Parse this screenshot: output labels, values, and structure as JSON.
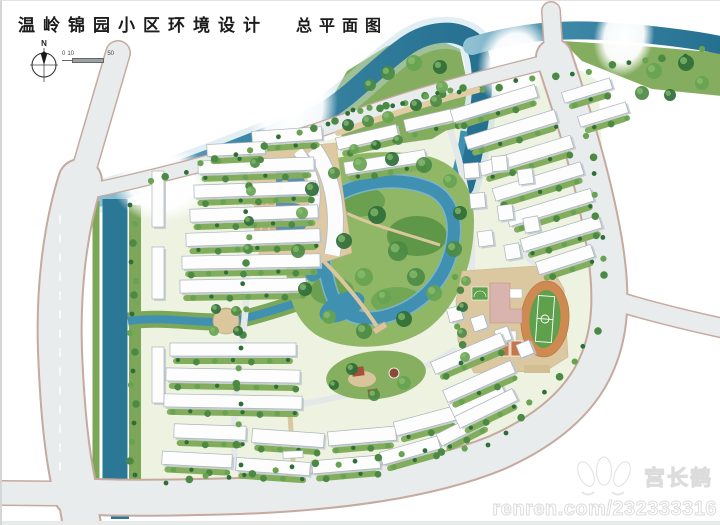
{
  "header": {
    "title": "温岭锦园小区环境设计",
    "subtitle": "总平面图"
  },
  "compass": {
    "north_label": "N"
  },
  "scale_bar": {
    "zero": "0",
    "ten": "10",
    "fifty": "50"
  },
  "watermark": {
    "name": "宫长鹤",
    "url": "renren.com/232333316"
  },
  "palette": {
    "road": "#e8eced",
    "road_edge": "#c6a99f",
    "river": "#2a7796",
    "river_light": "#9cc8d8",
    "bank_green": "#7da758",
    "park_green": "#8fb766",
    "tree_dark": "#2f6e38",
    "building": "#fdfdfd",
    "building_shadow": "#bfc9cd",
    "plaza_tan": "#dfc9a2",
    "track_orange": "#cf8a52",
    "pitch_green": "#5fa04c",
    "court_orange": "#c8764b",
    "school_pink": "#d9b3ae",
    "lake_blue": "#4090b2",
    "star_blue": "#b8d4ea"
  }
}
